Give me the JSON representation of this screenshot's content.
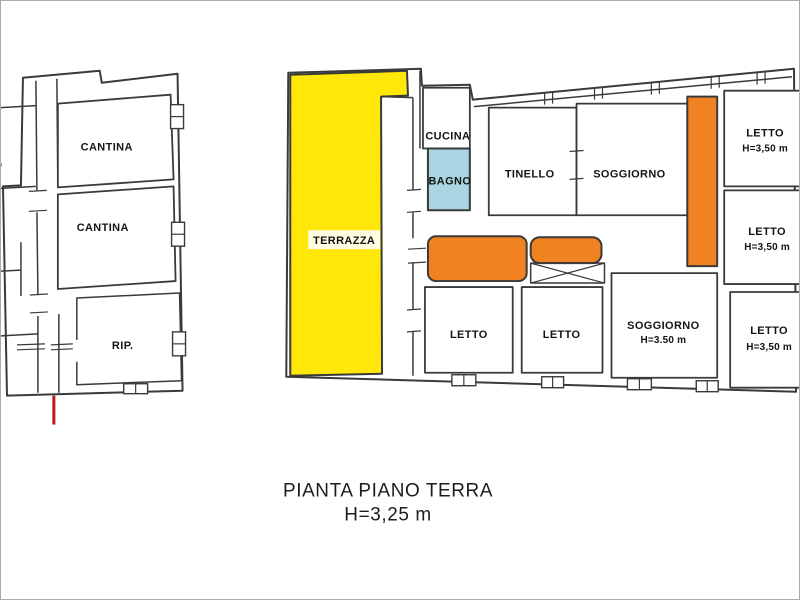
{
  "caption": {
    "title": "PIANTA PIANO TERRA",
    "height_note": "H=3,25 m"
  },
  "colors": {
    "terrace_yellow": "#ffe70a",
    "corridor_orange": "#f08222",
    "bath_cyan": "#a9d6e2",
    "entrance_red": "#c3161c",
    "wall": "#3a3a3a"
  },
  "annex_building": {
    "rooms": [
      {
        "label": "CANTINA"
      },
      {
        "label": "CANTINA"
      },
      {
        "label": "RIP."
      }
    ],
    "partial_label": "O"
  },
  "main_building": {
    "terrazza": {
      "label": "TERRAZZA"
    },
    "cucina": {
      "label": "CUCINA"
    },
    "bagno": {
      "label": "BAGNO"
    },
    "tinello": {
      "label": "TINELLO"
    },
    "soggiorno_top": {
      "label": "SOGGIORNO"
    },
    "letto_right_1": {
      "label": "LETTO",
      "height_note": "H=3,50 m"
    },
    "letto_right_2": {
      "label": "LETTO",
      "height_note": "H=3,50 m"
    },
    "letto_right_3": {
      "label": "LETTO",
      "height_note": "H=3,50 m"
    },
    "letto_bottom_1": {
      "label": "LETTO"
    },
    "letto_bottom_2": {
      "label": "LETTO"
    },
    "soggiorno_bottom": {
      "label": "SOGGIORNO",
      "height_note": "H=3.50 m"
    }
  }
}
